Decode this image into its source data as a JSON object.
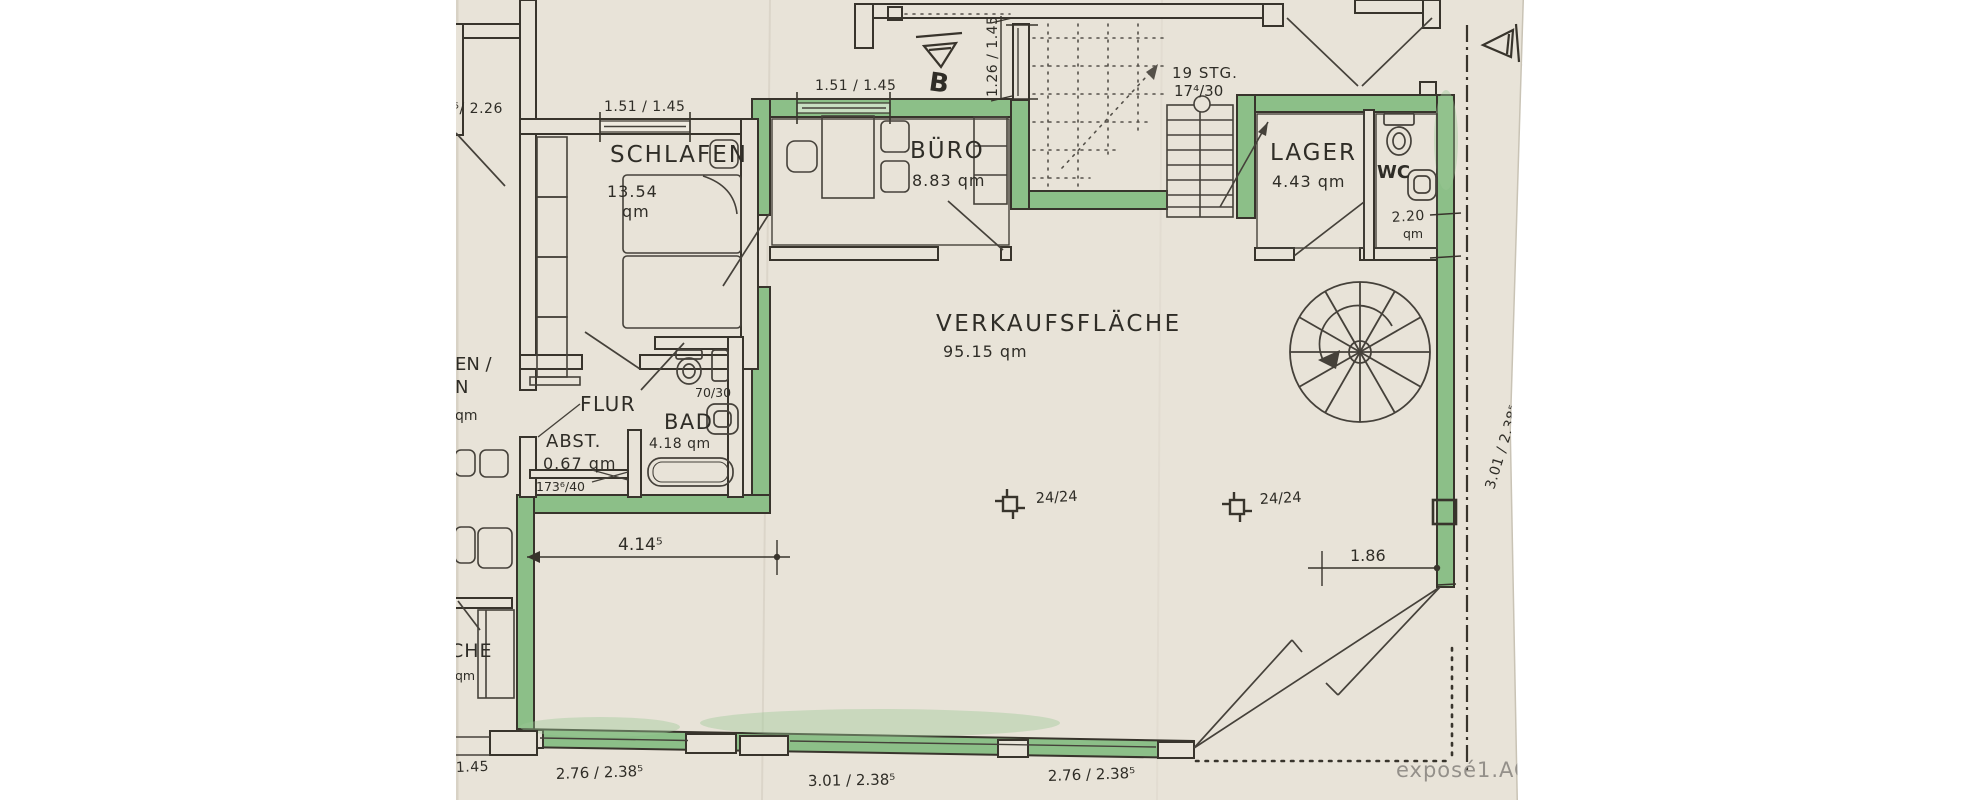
{
  "document_type": "scanned floor plan (Grundriss)",
  "colors": {
    "paper": "#e8e3d8",
    "ink": "#38342c",
    "wall_highlight_green": "#8cbf88",
    "watermark_gray": "#94908a",
    "margin": "#ffffff"
  },
  "labels": {
    "schlafen": "SCHLAFEN",
    "schlafen_area": "13.54",
    "schlafen_unit": "qm",
    "buero": "BÜRO",
    "buero_area": "8.83 qm",
    "lager": "LAGER",
    "lager_area": "4.43 qm",
    "wc": "WC",
    "wc_area": "2.20",
    "wc_unit": "qm",
    "bad": "BAD",
    "bad_area": "4.18 qm",
    "bad_window": "70/30",
    "abst": "ABST.",
    "abst_area": "0.67 qm",
    "abst_niche": "173⁶/40",
    "flur": "FLUR",
    "verkaufsflaeche": "VERKAUFSFLÄCHE",
    "verkaufsflaeche_area": "95.15 qm",
    "kueche_cut": "CHE",
    "kueche_unit": "qm",
    "left_room_cut_line1": "EN /",
    "left_room_cut_line2": "N",
    "left_room_cut_line3": "qm",
    "stairs_line1": "19 STG.",
    "stairs_line2": "17⁴/30",
    "column_left": "24/24",
    "column_right": "24/24",
    "section_mark_top": "B",
    "section_mark_right": "B"
  },
  "dimensions": {
    "top_left_partial": "8⁵/ 2.26",
    "schlafen_window": "1.51 / 1.45",
    "buero_window": "1.51 / 1.45",
    "stair_window_vertical": "1.26 / 1.45",
    "interior_width": "4.14⁵",
    "right_opening": "1.86",
    "right_wall_vertical": "3.01 / 2.38⁵",
    "bottom_left": "1.45",
    "bottom_window_1": "2.76 / 2.38⁵",
    "bottom_window_2": "3.01 / 2.38⁵",
    "bottom_window_3": "2.76 / 2.38⁵"
  },
  "watermark": "exposé1.AG"
}
